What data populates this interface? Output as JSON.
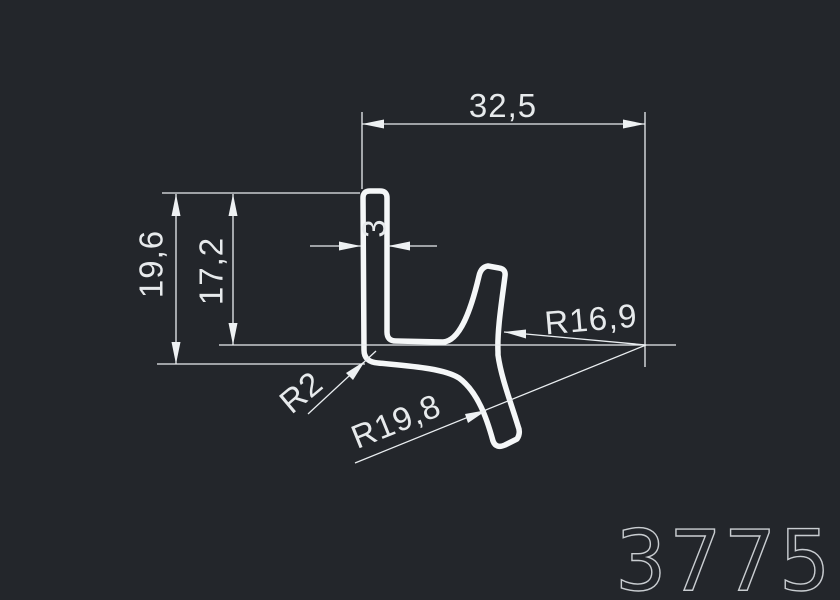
{
  "drawing": {
    "part_number": "3775",
    "dimensions": {
      "top_width": "32,5",
      "thickness": "3",
      "height_outer": "19,6",
      "height_inner": "17,2",
      "radius_upper": "R16,9",
      "radius_fillet": "R2",
      "radius_lower": "R19,8"
    },
    "colors": {
      "background": "#23262b",
      "line": "#e9edf0",
      "profile": "#f5f7f8",
      "part_number": "#c9cdd1"
    }
  }
}
